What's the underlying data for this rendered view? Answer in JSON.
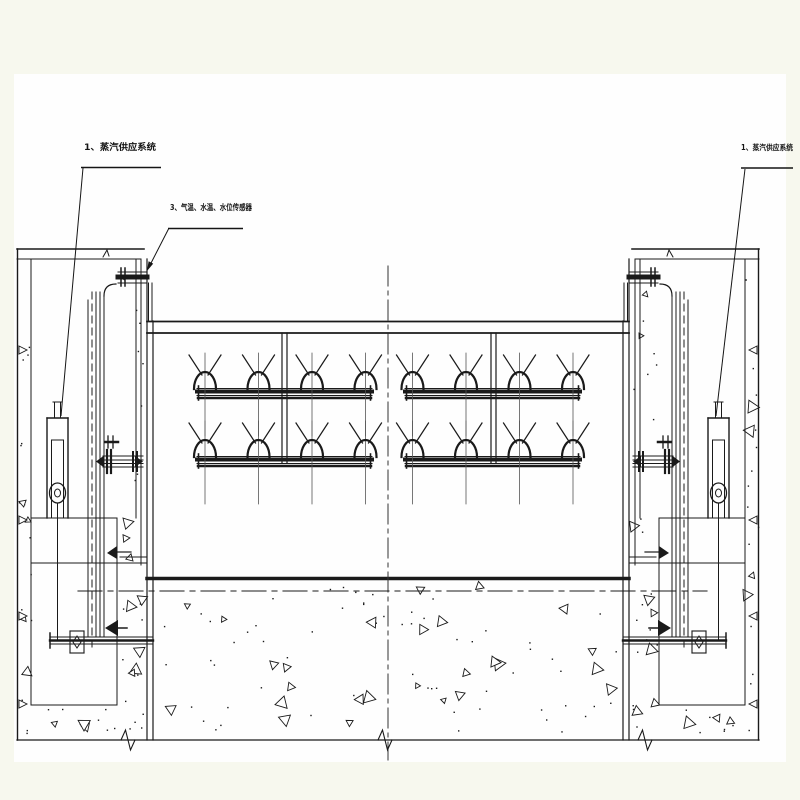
{
  "colors": {
    "background": "#f7f8ee",
    "sheet": "#fefefe",
    "line": "#1a1a1a",
    "guide_line": "#555555"
  },
  "labels": {
    "steam_supply_left": "1、蒸汽供应系统",
    "sensors": "3、气温、水温、水位传感器",
    "steam_supply_right": "1、蒸汽供应系统"
  },
  "legend_items": [
    {
      "number": "1",
      "text": "蒸汽供应系统"
    },
    {
      "number": "3",
      "text": "气温、水温、水位传感器"
    }
  ]
}
